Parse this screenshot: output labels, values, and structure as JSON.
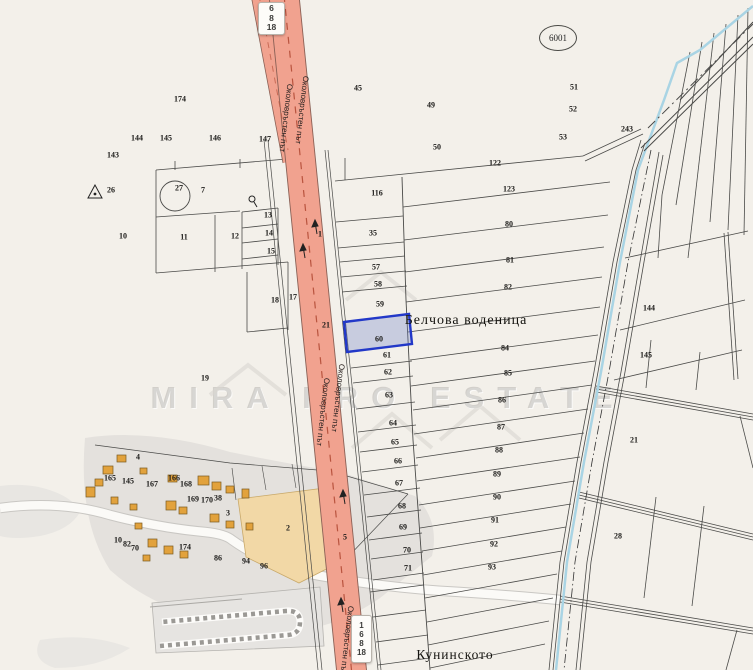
{
  "map": {
    "title": "cadastral-map",
    "road_name": "Околовръстен път",
    "road_ref": "6001",
    "watermark": {
      "text": "MIRA PRO ESTATE"
    },
    "route_badges": {
      "top": [
        "6",
        "8",
        "18"
      ],
      "bottom": [
        "1",
        "6",
        "8",
        "18"
      ]
    },
    "place_labels": [
      {
        "text": "Белчова воденица",
        "x": 466,
        "y": 321,
        "size": 14
      },
      {
        "text": "Кунинското",
        "x": 455,
        "y": 655,
        "size": 13.5
      }
    ],
    "road_labels": [
      {
        "x": 286,
        "y": 118
      },
      {
        "x": 302,
        "y": 110
      },
      {
        "x": 323,
        "y": 412
      },
      {
        "x": 338,
        "y": 398
      },
      {
        "x": 347,
        "y": 640
      }
    ],
    "selected_parcel": {
      "number": "60",
      "fill": "rgba(108,128,198,0.32)",
      "stroke": "#2238c8"
    },
    "colors": {
      "bg": "#f3f0ea",
      "road-fill": "#f1a28f",
      "road-dash": "#b9543f",
      "stream": "#a9d4e4",
      "orange-parcel": "#f2d8a6",
      "building": "#e2a23c",
      "gray-shade": "#dbd9d6",
      "line": "#4a4a48"
    },
    "parcel_labels": [
      {
        "n": "45",
        "x": 358,
        "y": 88
      },
      {
        "n": "49",
        "x": 431,
        "y": 105
      },
      {
        "n": "50",
        "x": 437,
        "y": 147
      },
      {
        "n": "174",
        "x": 180,
        "y": 99
      },
      {
        "n": "144",
        "x": 137,
        "y": 138
      },
      {
        "n": "145",
        "x": 166,
        "y": 138
      },
      {
        "n": "146",
        "x": 215,
        "y": 138
      },
      {
        "n": "147",
        "x": 265,
        "y": 139
      },
      {
        "n": "143",
        "x": 113,
        "y": 155
      },
      {
        "n": "51",
        "x": 574,
        "y": 87
      },
      {
        "n": "52",
        "x": 573,
        "y": 109
      },
      {
        "n": "53",
        "x": 563,
        "y": 137
      },
      {
        "n": "243",
        "x": 627,
        "y": 129
      },
      {
        "n": "122",
        "x": 495,
        "y": 163
      },
      {
        "n": "123",
        "x": 509,
        "y": 189
      },
      {
        "n": "116",
        "x": 377,
        "y": 193
      },
      {
        "n": "80",
        "x": 509,
        "y": 224
      },
      {
        "n": "81",
        "x": 510,
        "y": 260
      },
      {
        "n": "82",
        "x": 508,
        "y": 287
      },
      {
        "n": "84",
        "x": 505,
        "y": 348
      },
      {
        "n": "85",
        "x": 508,
        "y": 373
      },
      {
        "n": "86",
        "x": 502,
        "y": 400
      },
      {
        "n": "87",
        "x": 501,
        "y": 427
      },
      {
        "n": "88",
        "x": 499,
        "y": 450
      },
      {
        "n": "89",
        "x": 497,
        "y": 474
      },
      {
        "n": "90",
        "x": 497,
        "y": 497
      },
      {
        "n": "91",
        "x": 495,
        "y": 520
      },
      {
        "n": "92",
        "x": 494,
        "y": 544
      },
      {
        "n": "93",
        "x": 492,
        "y": 567
      },
      {
        "n": "26",
        "x": 111,
        "y": 190
      },
      {
        "n": "27",
        "x": 179,
        "y": 188
      },
      {
        "n": "7",
        "x": 203,
        "y": 190
      },
      {
        "n": "10",
        "x": 123,
        "y": 236
      },
      {
        "n": "11",
        "x": 184,
        "y": 237
      },
      {
        "n": "12",
        "x": 235,
        "y": 236
      },
      {
        "n": "13",
        "x": 268,
        "y": 215
      },
      {
        "n": "14",
        "x": 269,
        "y": 233
      },
      {
        "n": "15",
        "x": 271,
        "y": 251
      },
      {
        "n": "17",
        "x": 293,
        "y": 297
      },
      {
        "n": "18",
        "x": 275,
        "y": 300
      },
      {
        "n": "35",
        "x": 373,
        "y": 233
      },
      {
        "n": "57",
        "x": 376,
        "y": 267
      },
      {
        "n": "58",
        "x": 378,
        "y": 284
      },
      {
        "n": "59",
        "x": 380,
        "y": 304
      },
      {
        "n": "60",
        "x": 379,
        "y": 339
      },
      {
        "n": "61",
        "x": 387,
        "y": 355
      },
      {
        "n": "62",
        "x": 388,
        "y": 372
      },
      {
        "n": "63",
        "x": 389,
        "y": 395
      },
      {
        "n": "64",
        "x": 393,
        "y": 423
      },
      {
        "n": "65",
        "x": 395,
        "y": 442
      },
      {
        "n": "66",
        "x": 398,
        "y": 461
      },
      {
        "n": "67",
        "x": 399,
        "y": 483
      },
      {
        "n": "68",
        "x": 402,
        "y": 506
      },
      {
        "n": "69",
        "x": 403,
        "y": 527
      },
      {
        "n": "70",
        "x": 407,
        "y": 550
      },
      {
        "n": "71",
        "x": 408,
        "y": 568
      },
      {
        "n": "19",
        "x": 205,
        "y": 378
      },
      {
        "n": "21",
        "x": 326,
        "y": 325
      },
      {
        "n": "21",
        "x": 634,
        "y": 440
      },
      {
        "n": "28",
        "x": 618,
        "y": 536
      },
      {
        "n": "144",
        "x": 649,
        "y": 308
      },
      {
        "n": "145",
        "x": 646,
        "y": 355
      },
      {
        "n": "4",
        "x": 138,
        "y": 457
      },
      {
        "n": "165",
        "x": 110,
        "y": 478
      },
      {
        "n": "145",
        "x": 128,
        "y": 481
      },
      {
        "n": "166",
        "x": 174,
        "y": 478
      },
      {
        "n": "167",
        "x": 152,
        "y": 484
      },
      {
        "n": "168",
        "x": 186,
        "y": 484
      },
      {
        "n": "169",
        "x": 193,
        "y": 499
      },
      {
        "n": "170",
        "x": 207,
        "y": 500
      },
      {
        "n": "38",
        "x": 218,
        "y": 498
      },
      {
        "n": "3",
        "x": 228,
        "y": 513
      },
      {
        "n": "2",
        "x": 288,
        "y": 528
      },
      {
        "n": "10",
        "x": 118,
        "y": 540
      },
      {
        "n": "82",
        "x": 127,
        "y": 544
      },
      {
        "n": "70",
        "x": 135,
        "y": 548
      },
      {
        "n": "174",
        "x": 185,
        "y": 547
      },
      {
        "n": "86",
        "x": 218,
        "y": 558
      },
      {
        "n": "94",
        "x": 246,
        "y": 561
      },
      {
        "n": "96",
        "x": 264,
        "y": 566
      },
      {
        "n": "1",
        "x": 320,
        "y": 234
      },
      {
        "n": "5",
        "x": 345,
        "y": 537
      }
    ]
  }
}
